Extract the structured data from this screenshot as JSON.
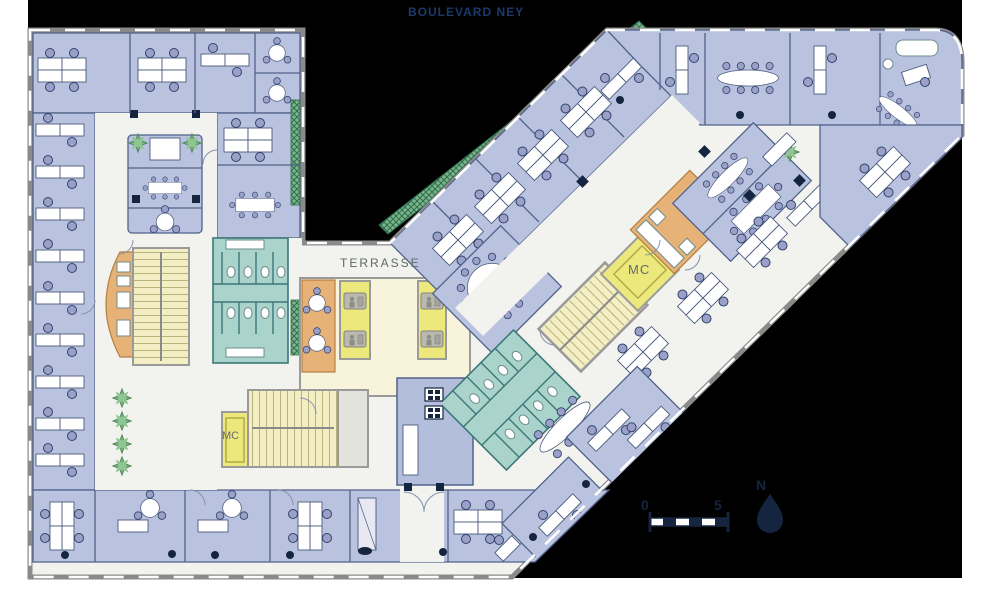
{
  "figure": {
    "type": "office floor plan",
    "street_label": "BOULEVARD NEY",
    "terrace_label": "TERRASSE",
    "rooms": {
      "mc_right_wing": "MC",
      "mc_left_wing": "MC"
    },
    "scale_bar": {
      "start": "0",
      "end": "5"
    },
    "compass": {
      "north": "N"
    }
  },
  "colors": {
    "background": "#000000",
    "office_blue": "#b9c3df",
    "reception_blue": "#b3bedd",
    "corridor_white": "#f2f2ef",
    "stair_core_yellow": "#f3eec4",
    "elevator_yellow": "#ece87c",
    "sanitary_teal": "#a9d3cb",
    "sanitary_wall_teal": "#3c7878",
    "kitchen_orange": "#e7b277",
    "terrace_green": "#dcead9",
    "trellis_green": "#7cb489",
    "chair_purple": "#9aa0c8",
    "column_navy": "#15253f",
    "outer_wall_gray": "#8a8a8a",
    "street_label_navy": "#1b3a6b"
  }
}
